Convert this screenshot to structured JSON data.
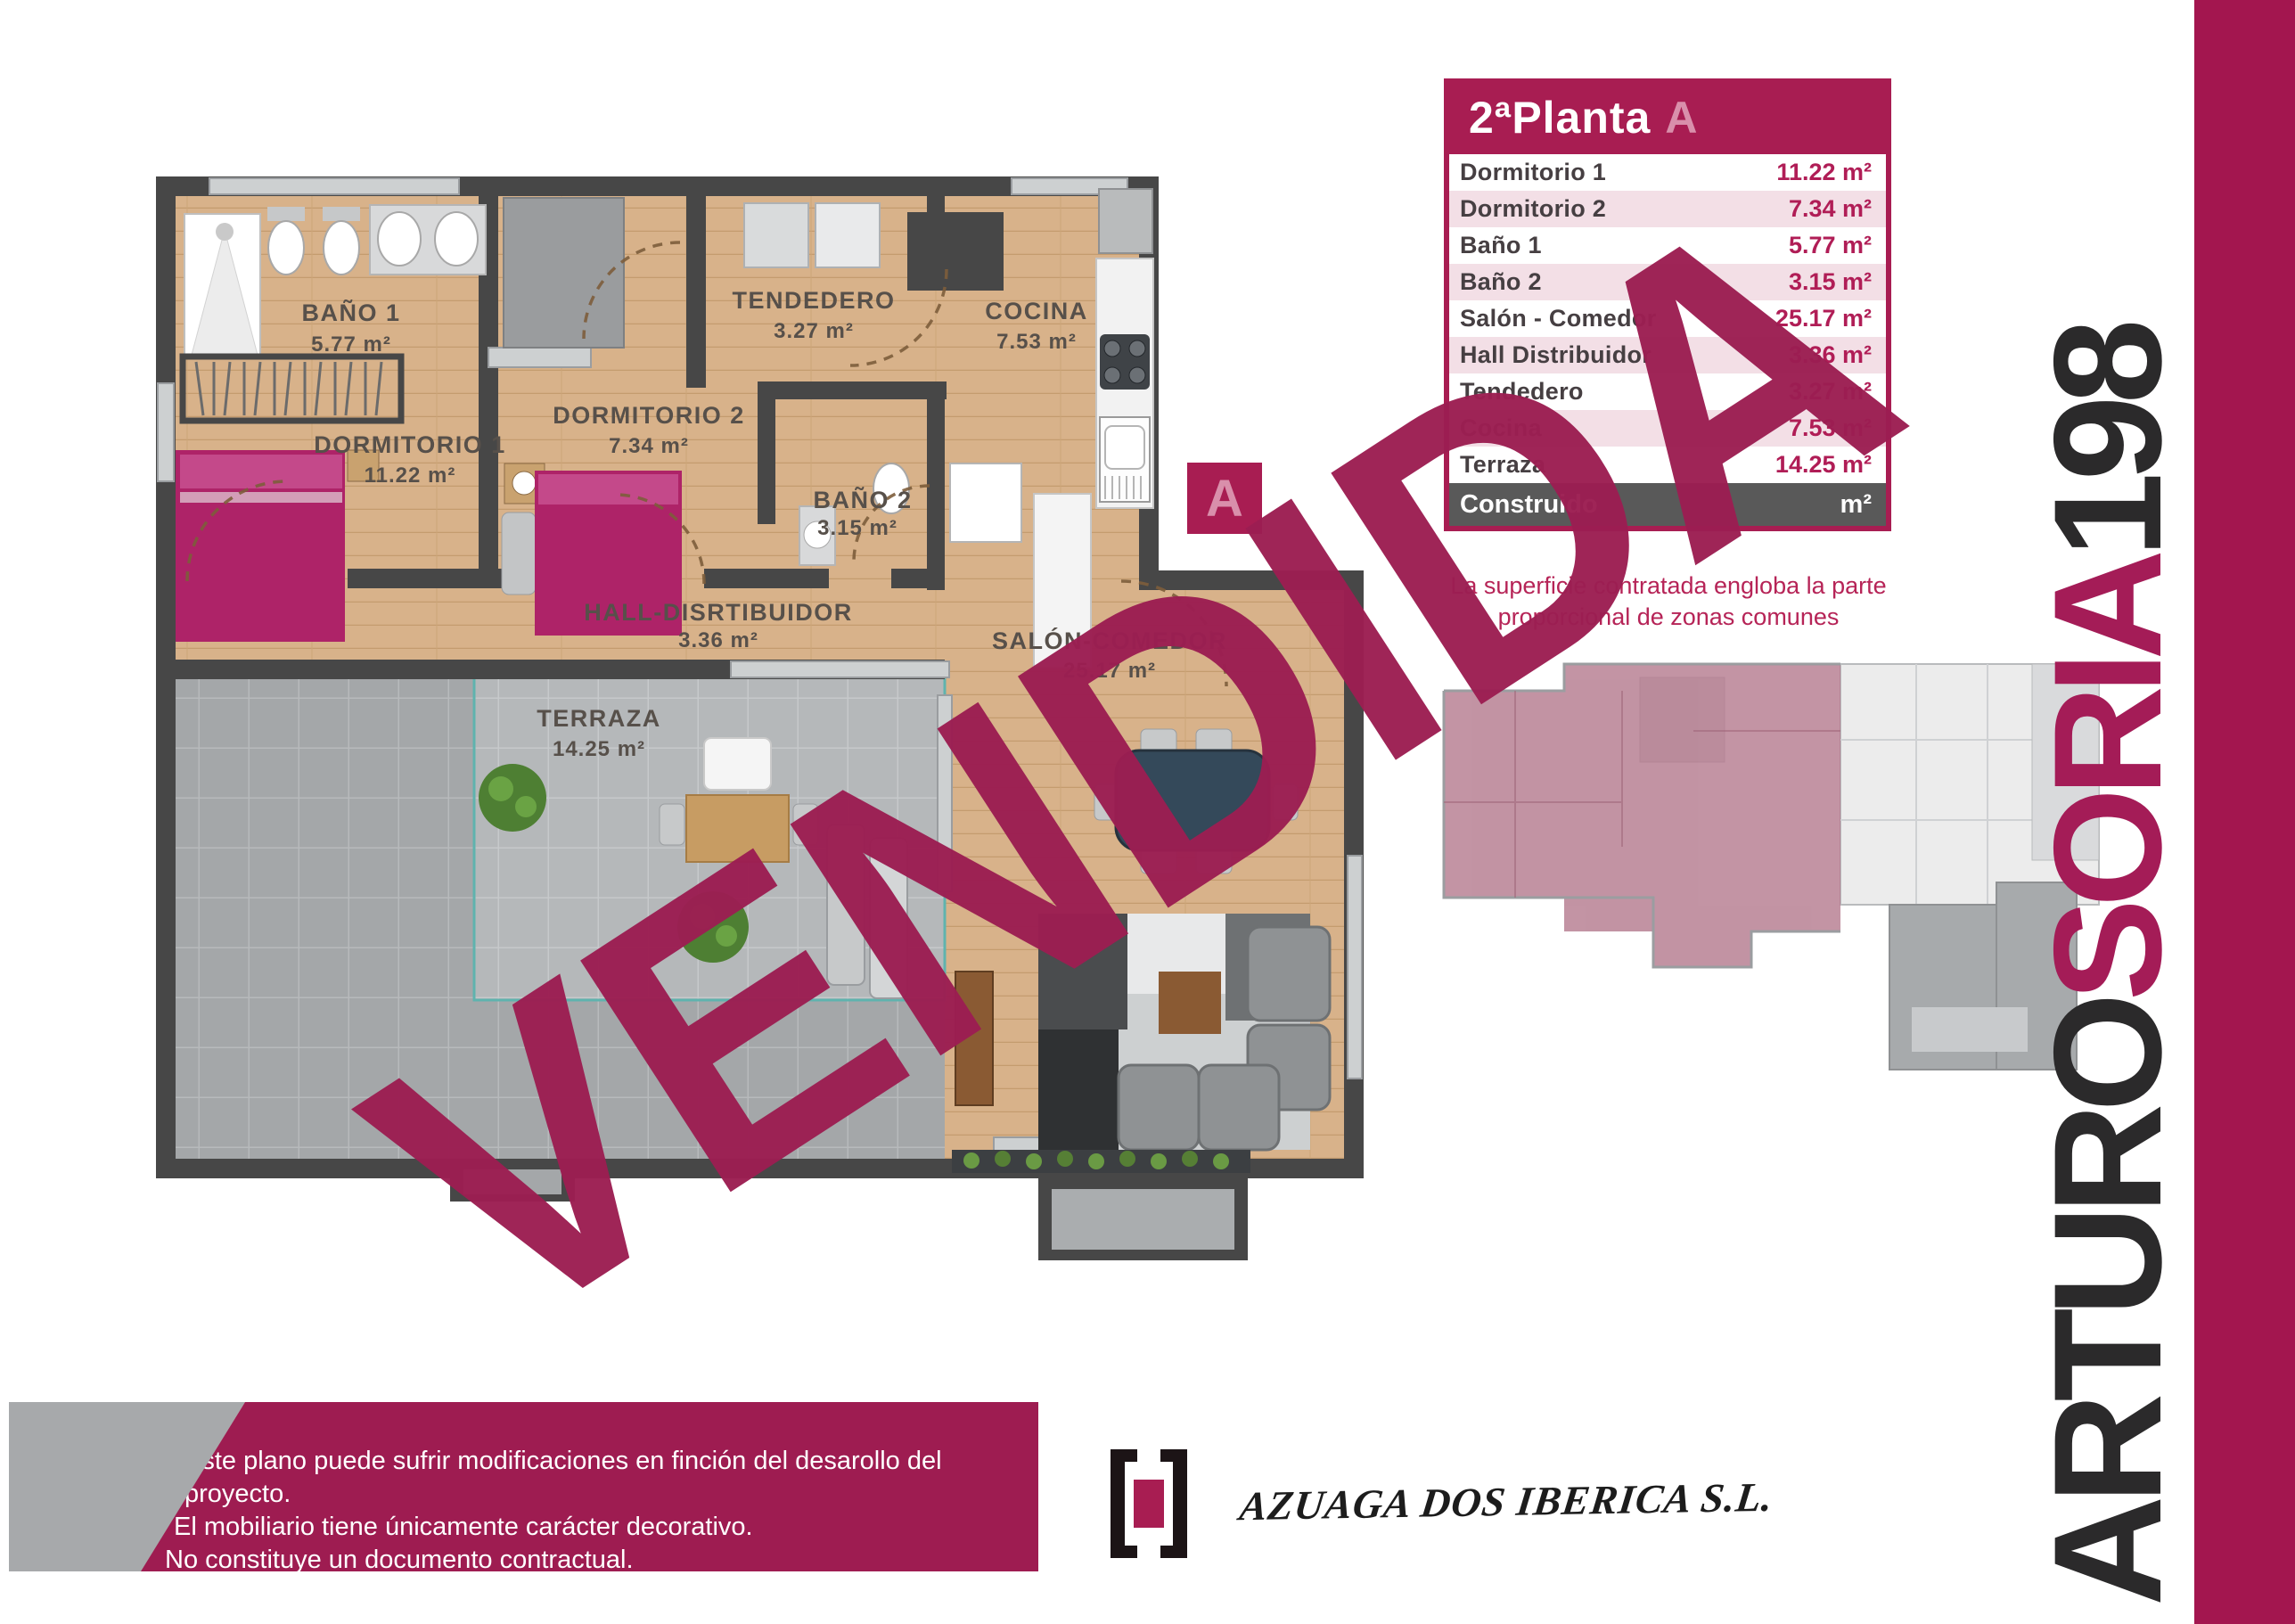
{
  "colors": {
    "brand_magenta": "#a81d52",
    "watermark": "#9c1e52",
    "bar": "#a3164f",
    "row_tint": "#f3dfe6",
    "value_text": "#b01d56",
    "total_row_bg": "#595959",
    "wood": "#d8b28a",
    "tile": "#a4a7a9",
    "wall": "#474747",
    "badge_letter": "#d98fab"
  },
  "header": {
    "floor": "2ªPlanta",
    "unit": "A"
  },
  "table": {
    "rows": [
      {
        "label": "Dormitorio 1",
        "value": "11.22 m²"
      },
      {
        "label": "Dormitorio 2",
        "value": "7.34 m²"
      },
      {
        "label": "Baño 1",
        "value": "5.77 m²"
      },
      {
        "label": "Baño 2",
        "value": "3.15 m²"
      },
      {
        "label": "Salón - Comedor",
        "value": "25.17 m²"
      },
      {
        "label": "Hall Distribuidor",
        "value": "3.36 m²"
      },
      {
        "label": "Tendedero",
        "value": "3.27 m²"
      },
      {
        "label": "Cocina",
        "value": "7.53 m²"
      },
      {
        "label": "Terraza",
        "value": "14.25 m²"
      }
    ],
    "total": {
      "label": "Construido",
      "value": "m²"
    }
  },
  "note": {
    "line1": "La superficie contratada engloba la parte",
    "line2": "proporcional de zonas comunes"
  },
  "plan": {
    "badge": "A",
    "rooms": [
      {
        "name": "BAÑO 1",
        "area": "5.77 m²"
      },
      {
        "name": "DORMITORIO 1",
        "area": "11.22 m²"
      },
      {
        "name": "DORMITORIO 2",
        "area": "7.34 m²"
      },
      {
        "name": "TENDEDERO",
        "area": "3.27 m²"
      },
      {
        "name": "COCINA",
        "area": "7.53 m²"
      },
      {
        "name": "BAÑO 2",
        "area": "3.15 m²"
      },
      {
        "name": "HALL-DISRTIBUIDOR",
        "area": "3.36 m²"
      },
      {
        "name": "SALÓN-COMEDOR",
        "area": "25.17 m²"
      },
      {
        "name": "TERRAZA",
        "area": "14.25 m²"
      }
    ]
  },
  "watermark": "VENDIDA",
  "brand": {
    "part1": "ARTURO",
    "part2": "SORIA",
    "part3": "198"
  },
  "disclaimer": {
    "lines": [
      "Este plano puede sufrir modificaciones en finción del desarollo del proyecto.",
      "El mobiliario tiene únicamente carácter decorativo.",
      "No constituye un documento contractual."
    ]
  },
  "company": "AZUAGA DOS IBERICA S.L."
}
